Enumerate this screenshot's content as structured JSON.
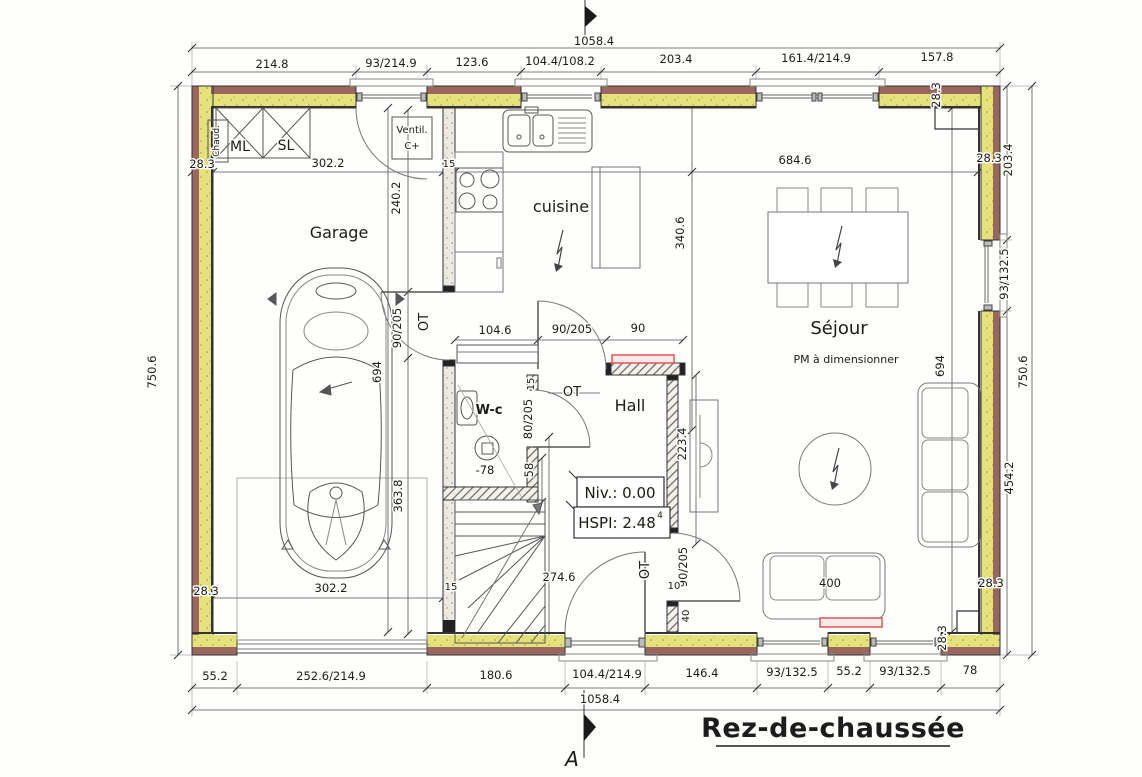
{
  "colors": {
    "wall_brown": "#9a675f",
    "insulation_yellow": "#e6e27a",
    "interior_wall_gray": "#eceae3",
    "line_dark": "#333333",
    "dim_line": "#555555",
    "accent_red": "#e25555"
  },
  "annotations": [
    {
      "n": "dim-top-seg1",
      "t": "214.8",
      "x": 272,
      "y": 68
    },
    {
      "n": "dim-top-seg2",
      "t": "93/214.9",
      "x": 391,
      "y": 67
    },
    {
      "n": "dim-top-seg3",
      "t": "123.6",
      "x": 472,
      "y": 66
    },
    {
      "n": "dim-top-seg4",
      "t": "104.4/108.2",
      "x": 560,
      "y": 65
    },
    {
      "n": "dim-top-seg5",
      "t": "203.4",
      "x": 676,
      "y": 63
    },
    {
      "n": "dim-top-seg6",
      "t": "161.4/214.9",
      "x": 816,
      "y": 62
    },
    {
      "n": "dim-top-seg7",
      "t": "157.8",
      "x": 937,
      "y": 61
    },
    {
      "n": "dim-top-total",
      "t": "1058.4",
      "x": 594,
      "y": 45
    },
    {
      "n": "dim-bottom-seg1",
      "t": "55.2",
      "x": 215,
      "y": 680
    },
    {
      "n": "dim-bottom-seg2",
      "t": "252.6/214.9",
      "x": 331,
      "y": 680
    },
    {
      "n": "dim-bottom-seg3",
      "t": "180.6",
      "x": 496,
      "y": 679
    },
    {
      "n": "dim-bottom-seg4",
      "t": "104.4/214.9",
      "x": 607,
      "y": 678
    },
    {
      "n": "dim-bottom-seg5",
      "t": "146.4",
      "x": 702,
      "y": 677
    },
    {
      "n": "dim-bottom-seg6",
      "t": "93/132.5",
      "x": 792,
      "y": 676
    },
    {
      "n": "dim-bottom-seg7",
      "t": "55.2",
      "x": 849,
      "y": 675
    },
    {
      "n": "dim-bottom-seg8",
      "t": "93/132.5",
      "x": 905,
      "y": 675
    },
    {
      "n": "dim-bottom-seg9",
      "t": "78",
      "x": 970,
      "y": 674
    },
    {
      "n": "dim-bottom-total",
      "t": "1058.4",
      "x": 600,
      "y": 703
    },
    {
      "n": "dim-left-total",
      "t": "750.6",
      "x": 156,
      "y": 372,
      "r": -90
    },
    {
      "n": "dim-left-thk-top",
      "t": "28.3",
      "x": 202,
      "y": 168
    },
    {
      "n": "dim-left-thk-bottom",
      "t": "28.3",
      "x": 206,
      "y": 595
    },
    {
      "n": "dim-right-inset-top",
      "t": "28.3",
      "x": 940,
      "y": 95,
      "r": -90
    },
    {
      "n": "dim-right-seg1",
      "t": "203.4",
      "x": 1012,
      "y": 160,
      "r": -90
    },
    {
      "n": "dim-right-thk-top",
      "t": "28.3",
      "x": 989,
      "y": 162
    },
    {
      "n": "dim-right-window",
      "t": "93/132.5",
      "x": 1008,
      "y": 274,
      "r": -90
    },
    {
      "n": "dim-right-total",
      "t": "750.6",
      "x": 1027,
      "y": 372,
      "r": -90
    },
    {
      "n": "dim-right-seg3",
      "t": "454.2",
      "x": 1013,
      "y": 478,
      "r": -90
    },
    {
      "n": "dim-right-thk-bottom",
      "t": "28.3",
      "x": 991,
      "y": 587
    },
    {
      "n": "dim-right-inset-bottom",
      "t": "28.3",
      "x": 946,
      "y": 638,
      "r": -90
    },
    {
      "n": "dim-garage-width-top",
      "t": "302.2",
      "x": 328,
      "y": 167
    },
    {
      "n": "dim-wall-thk-15",
      "t": "15",
      "x": 449,
      "y": 167,
      "s": 10
    },
    {
      "n": "dim-kitchen-sejour-width",
      "t": "684.6",
      "x": 795,
      "y": 164
    },
    {
      "n": "dim-garage-wall",
      "t": "240.2",
      "x": 400,
      "y": 198,
      "r": -90
    },
    {
      "n": "dim-kitchen-depth",
      "t": "340.6",
      "x": 684,
      "y": 233,
      "r": -90
    },
    {
      "n": "dim-garage-depth",
      "t": "694",
      "x": 381,
      "y": 372,
      "r": -90
    },
    {
      "n": "dim-sejour-depth",
      "t": "694",
      "x": 944,
      "y": 366,
      "r": -90
    },
    {
      "n": "dim-garage-door",
      "t": "90/205",
      "x": 401,
      "y": 328,
      "r": -90
    },
    {
      "n": "tag-garage-door",
      "t": "OT",
      "x": 428,
      "y": 322,
      "r": -90,
      "s": 13
    },
    {
      "n": "dim-hall-chain-1",
      "t": "104.6",
      "x": 495,
      "y": 334
    },
    {
      "n": "dim-hall-door",
      "t": "90/205",
      "x": 572,
      "y": 333
    },
    {
      "n": "dim-entry-width",
      "t": "90",
      "x": 638,
      "y": 332
    },
    {
      "n": "tag-hall-door",
      "t": "OT",
      "x": 572,
      "y": 396,
      "s": 13
    },
    {
      "n": "dim-wc-wall",
      "t": "15",
      "x": 534,
      "y": 384,
      "r": -90,
      "s": 10
    },
    {
      "n": "dim-wc-door",
      "t": "80/205",
      "x": 532,
      "y": 419,
      "r": -90
    },
    {
      "n": "dim-stair-58",
      "t": "58",
      "x": 533,
      "y": 470,
      "r": -90
    },
    {
      "n": "level-minus-78",
      "t": "-78",
      "x": 485,
      "y": 474
    },
    {
      "n": "dim-hall-wall",
      "t": "223.4",
      "x": 686,
      "y": 444,
      "r": -90
    },
    {
      "n": "dim-garage-lower",
      "t": "363.8",
      "x": 402,
      "y": 496,
      "r": -90
    },
    {
      "n": "dim-stair-length",
      "t": "274.6",
      "x": 559,
      "y": 581
    },
    {
      "n": "tag-sejour-door",
      "t": "OT",
      "x": 649,
      "y": 570,
      "r": -90,
      "s": 13
    },
    {
      "n": "dim-sejour-door",
      "t": "90/205",
      "x": 687,
      "y": 567,
      "r": -90
    },
    {
      "n": "dim-stub-10",
      "t": "10",
      "x": 674,
      "y": 589,
      "s": 10
    },
    {
      "n": "dim-stub-40",
      "t": "40",
      "x": 689,
      "y": 616,
      "r": -90,
      "s": 10
    },
    {
      "n": "dim-garage-width-bottom",
      "t": "302.2",
      "x": 331,
      "y": 592
    },
    {
      "n": "dim-wall-15-bottom",
      "t": "15",
      "x": 451,
      "y": 590,
      "s": 10
    },
    {
      "n": "dim-sofa",
      "t": "400",
      "x": 830,
      "y": 587
    },
    {
      "n": "room-garage",
      "t": "Garage",
      "x": 339,
      "y": 238,
      "s": 16
    },
    {
      "n": "room-cuisine",
      "t": "cuisine",
      "x": 561,
      "y": 212,
      "s": 16
    },
    {
      "n": "room-sejour",
      "t": "Séjour",
      "x": 839,
      "y": 334,
      "s": 18
    },
    {
      "n": "room-hall",
      "t": "Hall",
      "x": 630,
      "y": 411,
      "s": 16
    },
    {
      "n": "room-wc",
      "t": "W-c",
      "x": 489,
      "y": 414,
      "s": 13,
      "w": "bold"
    },
    {
      "n": "note-pm",
      "t": "PM à dimensionner",
      "x": 846,
      "y": 363,
      "s": 11
    },
    {
      "n": "label-chaud",
      "t": "Chaud.",
      "x": 219,
      "y": 141,
      "r": -90,
      "s": 9
    },
    {
      "n": "label-ml",
      "t": "ML",
      "x": 240,
      "y": 151,
      "s": 14
    },
    {
      "n": "label-sl",
      "t": "SL",
      "x": 286,
      "y": 150,
      "s": 14
    },
    {
      "n": "label-ventil",
      "t": "Ventil.",
      "x": 412,
      "y": 133,
      "s": 10
    },
    {
      "n": "label-ventil-c",
      "t": "C+",
      "x": 412,
      "y": 149,
      "s": 10
    },
    {
      "n": "level-niv",
      "t": "Niv.: 0.00",
      "x": 620,
      "y": 498,
      "s": 15
    },
    {
      "n": "level-hspi",
      "t": "HSPI: 2.48",
      "x": 617,
      "y": 528,
      "s": 15
    },
    {
      "n": "level-hspi-sup",
      "t": "4",
      "x": 660,
      "y": 518,
      "s": 9
    },
    {
      "n": "drawing-title",
      "t": "Rez-de-chaussée",
      "x": 833,
      "y": 737,
      "s": 27,
      "w": "bold",
      "c": "title"
    },
    {
      "n": "section-marker-a",
      "t": "A",
      "x": 572,
      "y": 766,
      "s": 20,
      "c": "italic"
    }
  ]
}
